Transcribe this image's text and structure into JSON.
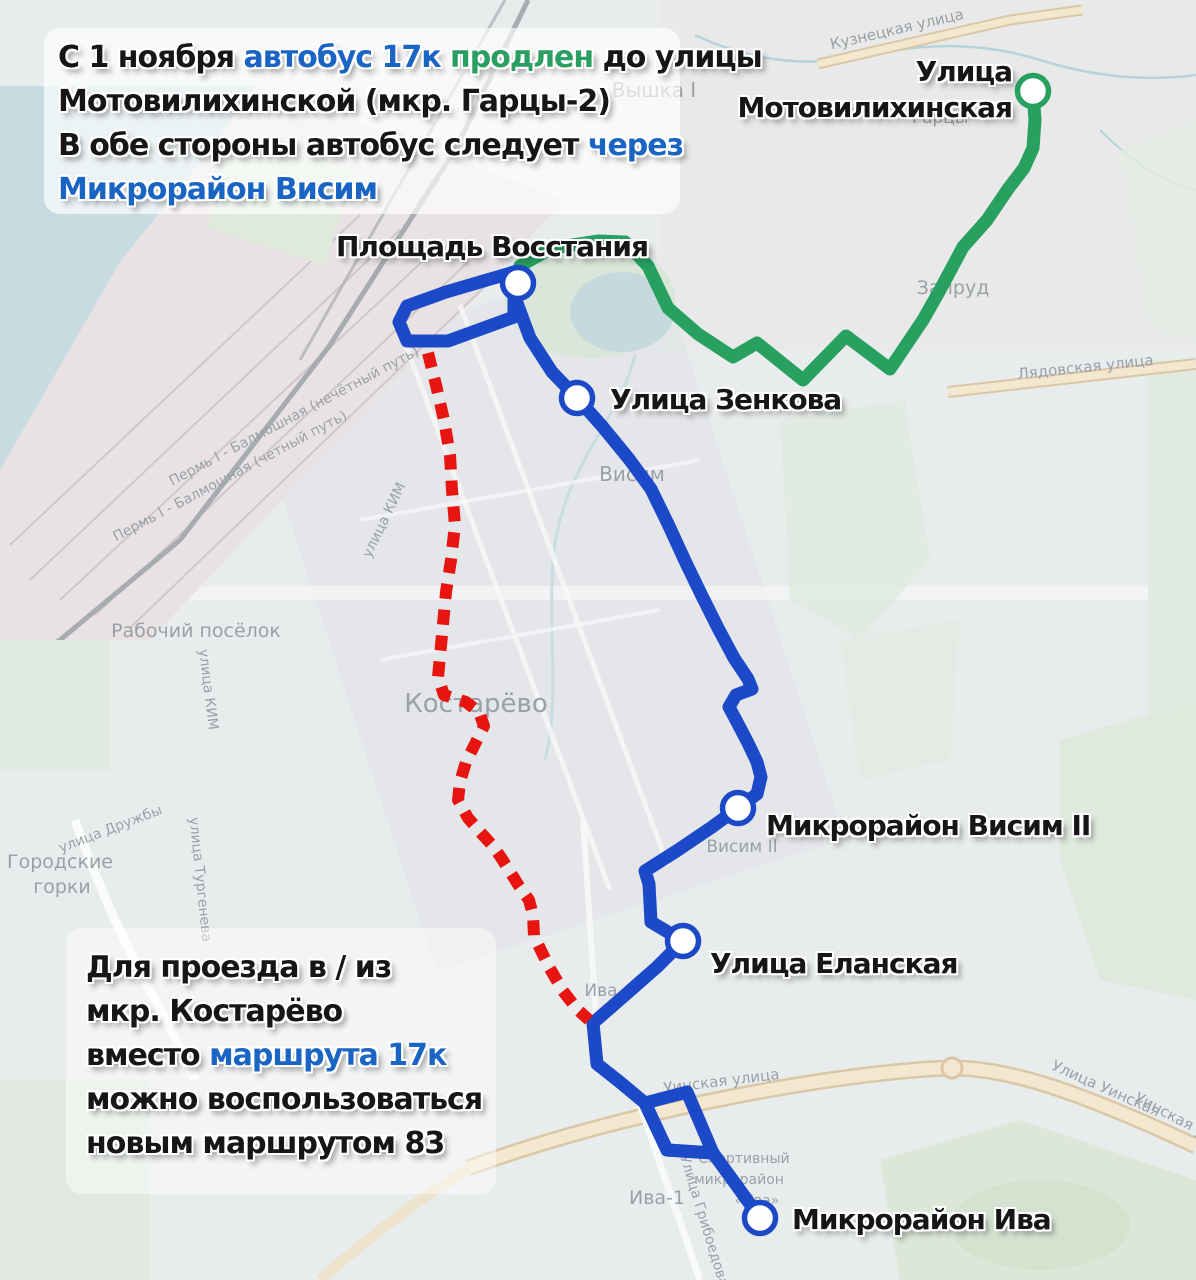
{
  "colors": {
    "route_blue": "#1b49c8",
    "route_green": "#27a060",
    "route_red": "#e81410",
    "text_blue": "#1a64c3",
    "text_green": "#2b9e62",
    "text_dark": "#161616",
    "marker_fill": "#ffffff"
  },
  "annotations": {
    "top": {
      "lines": [
        [
          {
            "t": "С 1 ноября ",
            "c": "dark"
          },
          {
            "t": "автобус 17к ",
            "c": "blue"
          },
          {
            "t": "продлен ",
            "c": "green"
          },
          {
            "t": "до улицы",
            "c": "dark"
          }
        ],
        [
          {
            "t": "Мотовилихинской (мкр. Гарцы-2)",
            "c": "dark"
          }
        ],
        [
          {
            "t": "В обе стороны автобус следует ",
            "c": "dark"
          },
          {
            "t": "через",
            "c": "blue"
          }
        ],
        [
          {
            "t": "Микрорайон Висим",
            "c": "blue"
          }
        ]
      ]
    },
    "bottom": {
      "lines": [
        [
          {
            "t": "Для проезда в / из",
            "c": "dark"
          }
        ],
        [
          {
            "t": "мкр. Костарёво",
            "c": "dark"
          }
        ],
        [
          {
            "t": "вместо ",
            "c": "dark"
          },
          {
            "t": "маршрута 17к",
            "c": "blue"
          }
        ],
        [
          {
            "t": "можно воспользоваться",
            "c": "dark"
          }
        ],
        [
          {
            "t": "новым маршрутом 83",
            "c": "dark"
          }
        ]
      ]
    }
  },
  "stops": [
    {
      "id": "stop-ulitsa-motovilikhinskaya",
      "label_lines": [
        "Улица",
        "Мотовилихинская"
      ],
      "x": 1033,
      "y": 91,
      "ring": "green",
      "label": {
        "right": 184,
        "top": 54,
        "align": "right"
      }
    },
    {
      "id": "stop-ploshchad-vosstaniya",
      "label_lines": [
        "Площадь Восстания"
      ],
      "x": 518,
      "y": 283,
      "ring": "blue",
      "label": {
        "left": 336,
        "top": 229,
        "align": "left"
      }
    },
    {
      "id": "stop-ulitsa-zenkova",
      "label_lines": [
        "Улица Зенкова"
      ],
      "x": 577,
      "y": 398,
      "ring": "blue",
      "label": {
        "left": 610,
        "top": 382,
        "align": "left"
      }
    },
    {
      "id": "stop-mikroraion-visim-2",
      "label_lines": [
        "Микрорайон Висим II"
      ],
      "x": 738,
      "y": 808,
      "ring": "blue",
      "label": {
        "left": 766,
        "top": 808,
        "align": "left"
      }
    },
    {
      "id": "stop-ulitsa-elanskaya",
      "label_lines": [
        "Улица Еланская"
      ],
      "x": 683,
      "y": 941,
      "ring": "blue",
      "label": {
        "left": 710,
        "top": 946,
        "align": "left"
      }
    },
    {
      "id": "stop-mikroraion-iva",
      "label_lines": [
        "Микрорайон Ива"
      ],
      "x": 760,
      "y": 1218,
      "ring": "blue",
      "label": {
        "left": 792,
        "top": 1202,
        "align": "left"
      }
    }
  ],
  "routes": [
    {
      "id": "route-17k-green-extension",
      "color": "green",
      "width": 13,
      "closed": false,
      "points": [
        [
          520,
          266
        ],
        [
          552,
          248
        ],
        [
          598,
          241
        ],
        [
          625,
          242
        ],
        [
          648,
          266
        ],
        [
          668,
          308
        ],
        [
          698,
          334
        ],
        [
          733,
          357
        ],
        [
          757,
          343
        ],
        [
          803,
          380
        ],
        [
          846,
          336
        ],
        [
          890,
          369
        ],
        [
          923,
          320
        ],
        [
          940,
          290
        ],
        [
          963,
          247
        ],
        [
          987,
          220
        ],
        [
          1008,
          189
        ],
        [
          1024,
          168
        ],
        [
          1033,
          148
        ],
        [
          1035,
          120
        ],
        [
          1033,
          93
        ]
      ]
    },
    {
      "id": "route-17k-blue-loop-vosstaniya",
      "color": "blue",
      "width": 13,
      "closed": true,
      "points": [
        [
          514,
          272
        ],
        [
          446,
          292
        ],
        [
          407,
          306
        ],
        [
          399,
          322
        ],
        [
          407,
          341
        ],
        [
          448,
          341
        ],
        [
          514,
          317
        ]
      ]
    },
    {
      "id": "route-17k-blue-main",
      "color": "blue",
      "width": 13,
      "closed": false,
      "points": [
        [
          517,
          303
        ],
        [
          530,
          338
        ],
        [
          552,
          372
        ],
        [
          577,
          398
        ],
        [
          602,
          426
        ],
        [
          629,
          459
        ],
        [
          651,
          489
        ],
        [
          669,
          526
        ],
        [
          686,
          563
        ],
        [
          702,
          596
        ],
        [
          718,
          628
        ],
        [
          734,
          658
        ],
        [
          748,
          679
        ],
        [
          752,
          689
        ],
        [
          736,
          695
        ],
        [
          729,
          707
        ],
        [
          737,
          722
        ],
        [
          748,
          743
        ],
        [
          757,
          762
        ],
        [
          761,
          777
        ],
        [
          757,
          794
        ],
        [
          738,
          808
        ],
        [
          712,
          827
        ],
        [
          678,
          850
        ],
        [
          645,
          871
        ],
        [
          649,
          884
        ],
        [
          651,
          922
        ],
        [
          683,
          941
        ],
        [
          657,
          967
        ],
        [
          624,
          996
        ],
        [
          593,
          1023
        ],
        [
          597,
          1064
        ],
        [
          621,
          1083
        ],
        [
          645,
          1103
        ],
        [
          667,
          1150
        ],
        [
          713,
          1153
        ],
        [
          737,
          1186
        ],
        [
          760,
          1218
        ]
      ]
    },
    {
      "id": "route-17k-blue-loop-iva",
      "color": "blue",
      "width": 13,
      "closed": true,
      "points": [
        [
          645,
          1103
        ],
        [
          687,
          1092
        ],
        [
          713,
          1153
        ],
        [
          667,
          1150
        ]
      ]
    },
    {
      "id": "route-old-17k-red-dashed",
      "color": "red",
      "width": 12,
      "closed": false,
      "dash": [
        15,
        11
      ],
      "points": [
        [
          428,
          353
        ],
        [
          436,
          385
        ],
        [
          444,
          420
        ],
        [
          450,
          455
        ],
        [
          452,
          490
        ],
        [
          455,
          525
        ],
        [
          451,
          560
        ],
        [
          446,
          592
        ],
        [
          442,
          635
        ],
        [
          438,
          677
        ],
        [
          444,
          695
        ],
        [
          466,
          702
        ],
        [
          479,
          712
        ],
        [
          484,
          726
        ],
        [
          476,
          742
        ],
        [
          466,
          762
        ],
        [
          460,
          782
        ],
        [
          458,
          800
        ],
        [
          468,
          818
        ],
        [
          482,
          834
        ],
        [
          492,
          845
        ],
        [
          500,
          856
        ],
        [
          509,
          870
        ],
        [
          519,
          886
        ],
        [
          529,
          900
        ],
        [
          533,
          915
        ],
        [
          534,
          936
        ],
        [
          549,
          967
        ],
        [
          563,
          991
        ],
        [
          577,
          1009
        ],
        [
          589,
          1020
        ]
      ]
    }
  ],
  "map_labels": [
    {
      "text": "Вышка I",
      "x": 654,
      "y": 97,
      "size": 20,
      "rot": 0
    },
    {
      "text": "Кузнецкая улица",
      "x": 898,
      "y": 34,
      "size": 15,
      "rot": -13,
      "color": "#8d9396"
    },
    {
      "text": "Гарцы",
      "x": 940,
      "y": 123,
      "size": 17,
      "rot": 0
    },
    {
      "text": "Запруд",
      "x": 953,
      "y": 294,
      "size": 19,
      "rot": 0
    },
    {
      "text": "Лядовская улица",
      "x": 1086,
      "y": 372,
      "size": 15,
      "rot": -6,
      "color": "#8d9396"
    },
    {
      "text": "Пермь I - Балмошная (нечётный путь)",
      "x": 296,
      "y": 420,
      "size": 14,
      "rot": -28
    },
    {
      "text": "Пермь I - Балмошная (четный путь)",
      "x": 232,
      "y": 480,
      "size": 14,
      "rot": -28
    },
    {
      "text": "улица КИМ",
      "x": 388,
      "y": 522,
      "size": 14,
      "rot": -64,
      "color": "#8d9396"
    },
    {
      "text": "улица КИМ",
      "x": 204,
      "y": 690,
      "size": 14,
      "rot": 83,
      "color": "#8d9396"
    },
    {
      "text": "Рабочий посёлок",
      "x": 196,
      "y": 637,
      "size": 19,
      "rot": 0
    },
    {
      "text": "Костарёво",
      "x": 476,
      "y": 712,
      "size": 26,
      "rot": 0
    },
    {
      "text": "Висим",
      "x": 632,
      "y": 481,
      "size": 20,
      "rot": 0
    },
    {
      "text": "Висим II",
      "x": 742,
      "y": 852,
      "size": 17,
      "rot": 0
    },
    {
      "text": "Городские",
      "x": 60,
      "y": 868,
      "size": 19,
      "rot": 0
    },
    {
      "text": "горки",
      "x": 62,
      "y": 893,
      "size": 19,
      "rot": 0
    },
    {
      "text": "улица Дружбы",
      "x": 112,
      "y": 833,
      "size": 14,
      "rot": -21,
      "color": "#8d9396"
    },
    {
      "text": "улица Тургенева",
      "x": 196,
      "y": 880,
      "size": 14,
      "rot": 84,
      "color": "#8d9396"
    },
    {
      "text": "Ива",
      "x": 601,
      "y": 996,
      "size": 17,
      "rot": 0
    },
    {
      "text": "Уинская улица",
      "x": 722,
      "y": 1086,
      "size": 15,
      "rot": -7,
      "color": "#8d9396"
    },
    {
      "text": "Улица Уинская",
      "x": 1104,
      "y": 1093,
      "size": 15,
      "rot": 24,
      "color": "#8d9396"
    },
    {
      "text": "Уинская улица",
      "x": 1185,
      "y": 1128,
      "size": 15,
      "rot": 28,
      "color": "#8d9396"
    },
    {
      "text": "Ива-1",
      "x": 657,
      "y": 1204,
      "size": 19,
      "rot": 0
    },
    {
      "text": "Улица Грибоедова",
      "x": 700,
      "y": 1222,
      "size": 14,
      "rot": 73,
      "color": "#8d9396"
    },
    {
      "text": "Спортивный",
      "x": 744,
      "y": 1163,
      "size": 14,
      "rot": 0
    },
    {
      "text": "микрорайон",
      "x": 739,
      "y": 1184,
      "size": 14,
      "rot": 0
    },
    {
      "text": "«Ива»",
      "x": 757,
      "y": 1205,
      "size": 14,
      "rot": 0
    }
  ]
}
